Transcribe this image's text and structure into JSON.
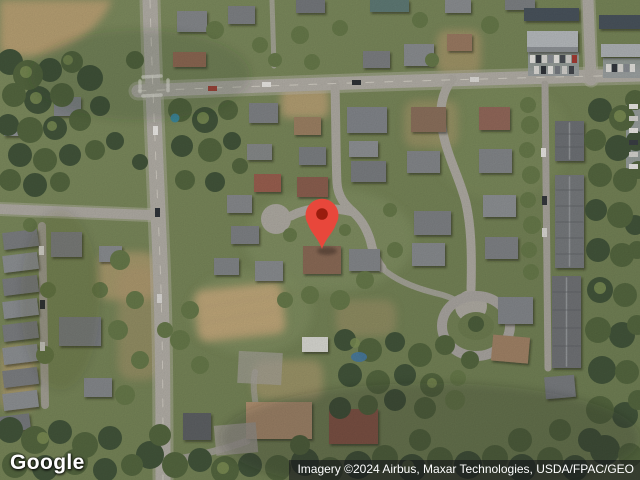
{
  "map": {
    "logo_label": "Google",
    "attribution": "Imagery ©2024 Airbus, Maxar Technologies, USDA/FPAC/GEO",
    "pin_color": "#E8473B",
    "pin_dot_color": "#9A1C0E",
    "attribution_bg": "rgba(16,16,24,0.55)"
  }
}
